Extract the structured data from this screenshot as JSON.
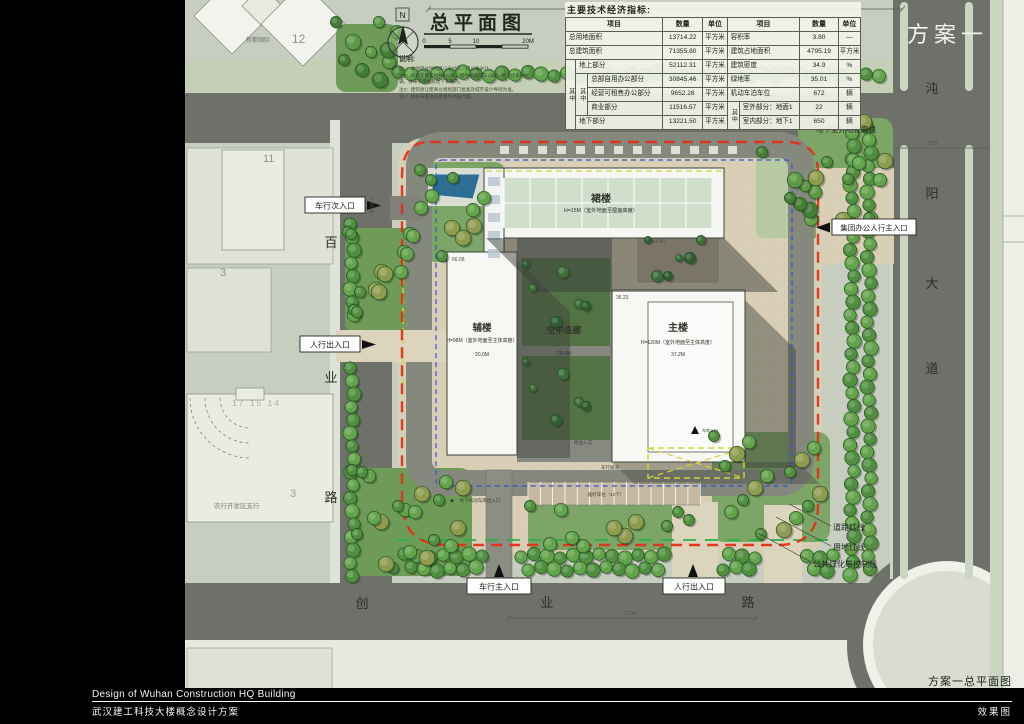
{
  "scheme_label": "方案一",
  "plan_caption": "方案一总平面图",
  "footer": {
    "title_en": "Design of Wuhan Construction HQ Building",
    "title_cn": "武汉建工科技大楼概念设计方案",
    "right": "效果图"
  },
  "plan": {
    "title": "总平面图",
    "north_label": "N",
    "scale_ticks": [
      "0",
      "5",
      "10",
      "20M"
    ],
    "notes_title": "说明:",
    "notes": [
      "注1：本图尺寸除标高以米计外，均以毫米计。",
      "注2：机动车停车位共672辆，其中地面停车22辆、地下停车650辆，分布于场地及地下车库内。",
      "注3：建筑退让距离以规划部门批复及城市设计导则为准。",
      "注4：绿化布置详见景观专项设计图。"
    ],
    "buildings": {
      "podium": {
        "name": "裙楼",
        "sub": "H=15M（室外地面至屋面高度）"
      },
      "annex": {
        "name": "辅楼",
        "sub": "H=98M（室外地面至主体高度）",
        "dim": "20.0M"
      },
      "corridor": {
        "name": "空中连廊",
        "dim": "20.0M"
      },
      "main": {
        "name": "主楼",
        "sub": "H=120M（室外地面至主体高度）",
        "dim": "37.2M"
      }
    },
    "entrances": {
      "veh_secondary": "车行次入口",
      "ped_west": "人行出入口",
      "group_main": "集团办公人行主入口",
      "veh_main": "车行主入口",
      "ped_south": "人行出入口"
    },
    "lines": {
      "basement": "地下室外墙轮廓线",
      "road_red": "道路红线",
      "site_red": "用地红线",
      "greenbelt": "公共绿化带控制线"
    },
    "roads": {
      "west": [
        "百",
        "业",
        "路"
      ],
      "south": [
        "创",
        "业",
        "路"
      ],
      "east": [
        "沌",
        "阳",
        "大",
        "道"
      ]
    },
    "context": {
      "estate": "新都国际",
      "n12": "12",
      "n11": "11",
      "n3a": "3",
      "grid_nums": "17 15 14",
      "bank": "农行开发区支行",
      "n3b": "3"
    },
    "small_labels": {
      "temp_parking": "临时车位（12个）",
      "biz_entry": "商业入口",
      "ramp": "车行坡道",
      "garage_sw": "地下机动车库出入口",
      "garage_e": "车库入口"
    },
    "dims": {
      "a": "66.68",
      "b": "37.01",
      "c": "A3.46",
      "d": "36.23",
      "e": "77.04",
      "f": "32.0",
      "g": "7.08"
    }
  },
  "table": {
    "title": "主要技术经济指标:",
    "h": [
      "项目",
      "数量",
      "单位",
      "项目",
      "数量",
      "单位"
    ],
    "group_label": "其中",
    "rows": {
      "r1": {
        "l": "总用地面积",
        "lv": "13714.22",
        "lu": "平方米",
        "r": "容积率",
        "rv": "3.80",
        "ru": "—"
      },
      "r2": {
        "l": "总建筑面积",
        "lv": "71355.80",
        "lu": "平方米",
        "r": "建筑占地面积",
        "rv": "4795.19",
        "ru": "平方米"
      },
      "r3": {
        "l": "地上部分",
        "lv": "52112.31",
        "lu": "平方米",
        "r": "建筑密度",
        "rv": "34.9",
        "ru": "%"
      },
      "r4": {
        "l": "总部自用办公部分",
        "lv": "30845.46",
        "lu": "平方米",
        "r": "绿地率",
        "rv": "35.01",
        "ru": "%"
      },
      "r5": {
        "l": "经营可租售办公部分",
        "lv": "9652.28",
        "lu": "平方米",
        "r": "机动车泊车位",
        "rv": "672",
        "ru": "辆"
      },
      "r6": {
        "l": "商业部分",
        "lv": "11516.57",
        "lu": "平方米",
        "r": "室外部分：地面1",
        "rv": "22",
        "ru": "辆"
      },
      "r7": {
        "l": "地下部分",
        "lv": "13221.50",
        "lu": "平方米",
        "r": "室内部分：地下1",
        "rv": "650",
        "ru": "辆"
      }
    }
  },
  "colors": {
    "site_red_line": "#e2301c",
    "underground_blue": "#2f55cc",
    "greenbelt_green": "#2fae4a",
    "fire_lane_yellow": "#d4d23c",
    "road_gray": "#6e716a",
    "tree_green": "#4f8f3f"
  }
}
